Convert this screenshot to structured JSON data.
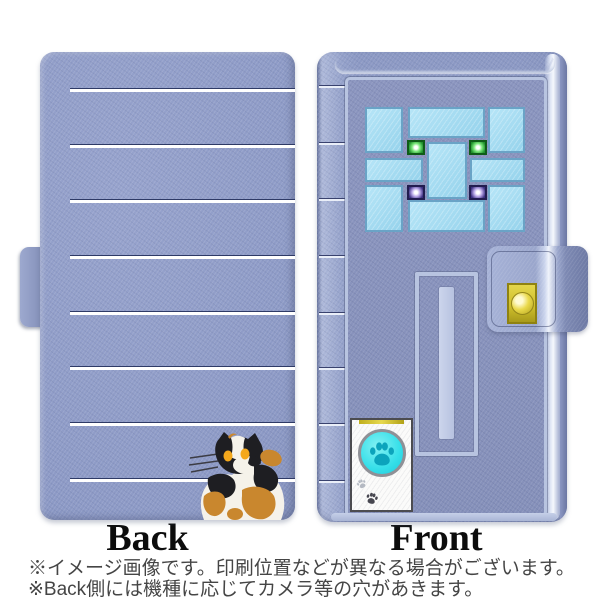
{
  "product_preview": {
    "back_label": "Back",
    "front_label": "Front",
    "notes": [
      "※イメージ画像です。印刷位置などが異なる場合がございます。",
      "※Back側には機種に応じてカメラ等の穴があきます。"
    ]
  },
  "design": {
    "back": "periwinkle leather phone-case back with white horizontal stitch lines and calico cat",
    "front": "phone-case front styled as a blue door with mosaic windows, mail slot, gold snap and paw-print intercom"
  },
  "colors": {
    "case_periwinkle": "#8c99c4",
    "door_panel_blue": "#8791bb",
    "stripe_white": "#ffffff",
    "stripe_navy": "#2e3a66",
    "window_light_blue": "#a3ddf2",
    "window_frame_blue": "#6aa3c6",
    "window_light_green": "#1e8f2a",
    "window_light_purple": "#3c2f80",
    "doorknob_gold": "#d7c82e",
    "intercom_button_cyan": "#35dfe9",
    "paw_teal": "#0ca4bc",
    "cat_black": "#1e1e22",
    "cat_white": "#f5f2ea",
    "cat_caramel": "#c9872e",
    "cat_eye_amber": "#f4a81c"
  }
}
